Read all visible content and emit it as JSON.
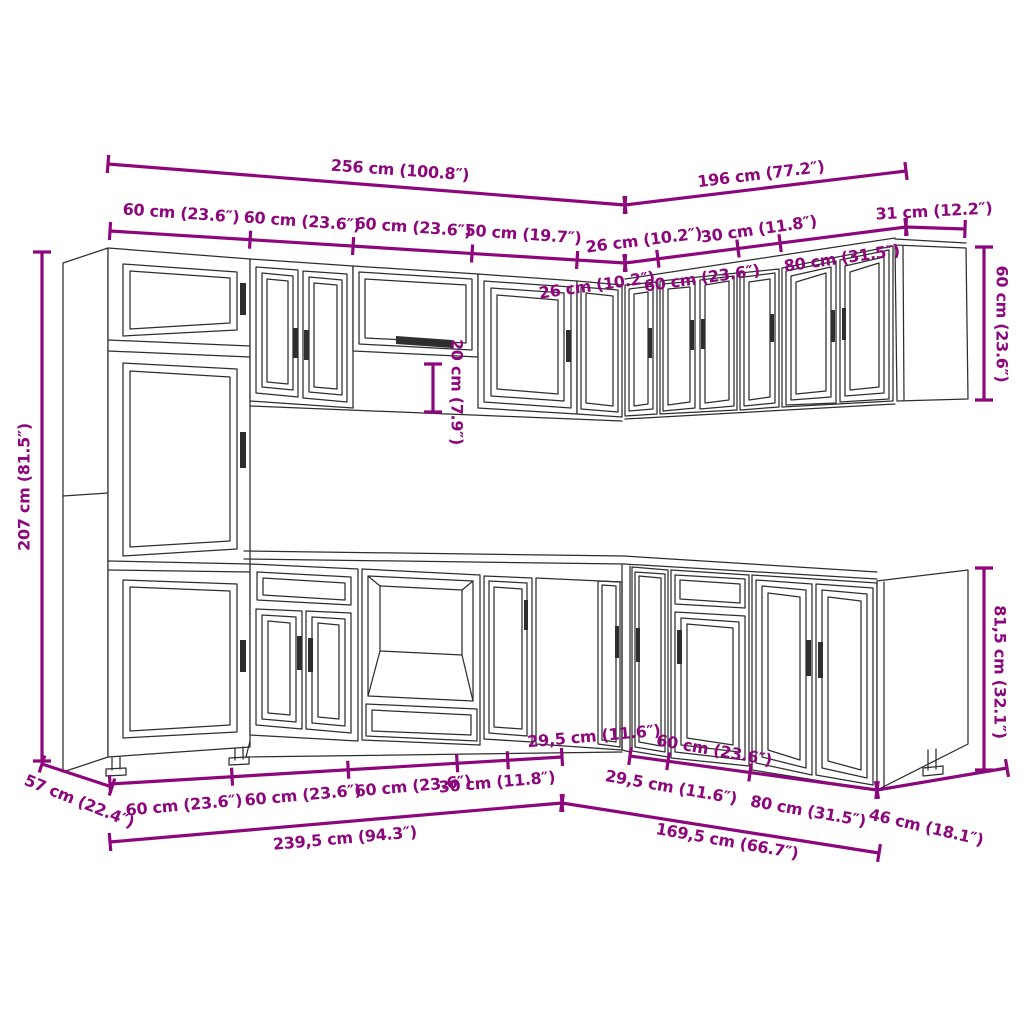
{
  "title": "Kitchen cabinet set dimension diagram",
  "colors": {
    "dimension": "#8d077c",
    "linework": "#2e2e2e",
    "background": "#ffffff"
  },
  "dimensions": {
    "labels": [
      {
        "id": "total-top-left",
        "text": "256 cm (100.8″)",
        "x": 400,
        "y": 171,
        "rot": 4
      },
      {
        "id": "total-top-right",
        "text": "196 cm (77.2″)",
        "x": 761,
        "y": 175,
        "rot": -7
      },
      {
        "id": "wall-seg-60a",
        "text": "60 cm (23.6″)",
        "x": 181,
        "y": 214,
        "rot": 4
      },
      {
        "id": "wall-seg-60b",
        "text": "60 cm (23.6″)",
        "x": 302,
        "y": 222,
        "rot": 4
      },
      {
        "id": "wall-seg-60c",
        "text": "60 cm (23.6″)",
        "x": 413,
        "y": 228,
        "rot": 4
      },
      {
        "id": "wall-seg-50",
        "text": "50 cm (19.7″)",
        "x": 523,
        "y": 235,
        "rot": 4
      },
      {
        "id": "wall-seg-26-right",
        "text": "26 cm (10.2″)",
        "x": 644,
        "y": 241,
        "rot": -7
      },
      {
        "id": "wall-seg-30-right",
        "text": "30 cm (11.8″)",
        "x": 759,
        "y": 230,
        "rot": -8
      },
      {
        "id": "end-depth-31",
        "text": "31 cm (12.2″)",
        "x": 934,
        "y": 212,
        "rot": -3
      },
      {
        "id": "inner-seg-26",
        "text": "26 cm (10.2″)",
        "x": 597,
        "y": 286,
        "rot": -8
      },
      {
        "id": "inner-seg-60",
        "text": "60 cm (23.6″)",
        "x": 702,
        "y": 279,
        "rot": -8
      },
      {
        "id": "inner-seg-80",
        "text": "80 cm (31.5″)",
        "x": 842,
        "y": 259,
        "rot": -8
      },
      {
        "id": "height-total-207",
        "text": "207 cm (81.5″)",
        "x": 25,
        "y": 487,
        "rot": -90
      },
      {
        "id": "gap-20",
        "text": "20 cm (7.9″)",
        "x": 456,
        "y": 392,
        "rot": 90
      },
      {
        "id": "wall-height-60",
        "text": "60 cm (23.6″)",
        "x": 1001,
        "y": 324,
        "rot": 90
      },
      {
        "id": "base-height-815",
        "text": "81,5 cm (32.1″)",
        "x": 999,
        "y": 672,
        "rot": 90
      },
      {
        "id": "depth-57",
        "text": "57 cm (22.4″)",
        "x": 79,
        "y": 802,
        "rot": 22
      },
      {
        "id": "base-seg-60a",
        "text": "60 cm (23.6″)",
        "x": 184,
        "y": 806,
        "rot": -5
      },
      {
        "id": "base-seg-60b",
        "text": "60 cm (23.6″)",
        "x": 303,
        "y": 796,
        "rot": -5
      },
      {
        "id": "base-seg-60c",
        "text": "60 cm (23.6″)",
        "x": 413,
        "y": 787,
        "rot": -5
      },
      {
        "id": "base-seg-30",
        "text": "30 cm (11.8″)",
        "x": 497,
        "y": 783,
        "rot": -5
      },
      {
        "id": "base-seg-295-left",
        "text": "29,5 cm (11.6″)",
        "x": 594,
        "y": 737,
        "rot": -5
      },
      {
        "id": "base-seg-295-right",
        "text": "29,5 cm (11.6″)",
        "x": 671,
        "y": 788,
        "rot": 10
      },
      {
        "id": "base-seg-60-right",
        "text": "60 cm (23.6″)",
        "x": 714,
        "y": 751,
        "rot": 10
      },
      {
        "id": "base-seg-80-right",
        "text": "80 cm (31.5″)",
        "x": 808,
        "y": 812,
        "rot": 10
      },
      {
        "id": "depth-46",
        "text": "46 cm (18.1″)",
        "x": 926,
        "y": 828,
        "rot": 13
      },
      {
        "id": "base-total-left",
        "text": "239,5 cm (94.3″)",
        "x": 345,
        "y": 839,
        "rot": -5
      },
      {
        "id": "base-total-right",
        "text": "169,5 cm (66.7″)",
        "x": 727,
        "y": 842,
        "rot": 10
      }
    ],
    "lines": [
      {
        "id": "l-256",
        "x1": 108,
        "y1": 164,
        "x2": 625,
        "y2": 205,
        "ticks": [
          0,
          1
        ]
      },
      {
        "id": "l-196",
        "x1": 625,
        "y1": 205,
        "x2": 906,
        "y2": 171,
        "ticks": [
          0,
          1
        ]
      },
      {
        "id": "l-wall-left",
        "x1": 110,
        "y1": 231,
        "x2": 625,
        "y2": 263,
        "ticks": [
          0,
          0.272,
          0.472,
          0.703,
          0.907,
          1
        ]
      },
      {
        "id": "l-wall-right",
        "x1": 625,
        "y1": 263,
        "x2": 906,
        "y2": 227,
        "ticks": [
          0,
          0.117,
          0.402,
          0.552,
          1
        ]
      },
      {
        "id": "l-31",
        "x1": 906,
        "y1": 227,
        "x2": 965,
        "y2": 229,
        "ticks": [
          0,
          1
        ]
      },
      {
        "id": "l-207",
        "x1": 42,
        "y1": 252,
        "x2": 42,
        "y2": 761,
        "ticks": [
          0,
          1
        ]
      },
      {
        "id": "l-20",
        "x1": 433,
        "y1": 364,
        "x2": 433,
        "y2": 412,
        "ticks": [
          0,
          1
        ]
      },
      {
        "id": "l-60v",
        "x1": 984,
        "y1": 247,
        "x2": 984,
        "y2": 400,
        "ticks": [
          0,
          1
        ]
      },
      {
        "id": "l-815v",
        "x1": 984,
        "y1": 568,
        "x2": 984,
        "y2": 770,
        "ticks": [
          0,
          1
        ]
      },
      {
        "id": "l-57",
        "x1": 42,
        "y1": 764,
        "x2": 112,
        "y2": 787,
        "ticks": [
          0,
          1
        ]
      },
      {
        "id": "l-base-left",
        "x1": 110,
        "y1": 784,
        "x2": 562,
        "y2": 757,
        "ticks": [
          0,
          0.27,
          0.527,
          0.768,
          0.88,
          1
        ]
      },
      {
        "id": "l-base-right",
        "x1": 630,
        "y1": 756,
        "x2": 877,
        "y2": 790,
        "ticks": [
          0,
          0.154,
          0.486,
          1
        ]
      },
      {
        "id": "l-46",
        "x1": 877,
        "y1": 790,
        "x2": 1007,
        "y2": 768,
        "ticks": [
          0,
          1
        ]
      },
      {
        "id": "l-2395",
        "x1": 110,
        "y1": 842,
        "x2": 562,
        "y2": 803,
        "ticks": [
          0,
          1
        ]
      },
      {
        "id": "l-1695",
        "x1": 562,
        "y1": 803,
        "x2": 879,
        "y2": 853,
        "ticks": [
          0,
          1
        ]
      }
    ]
  }
}
